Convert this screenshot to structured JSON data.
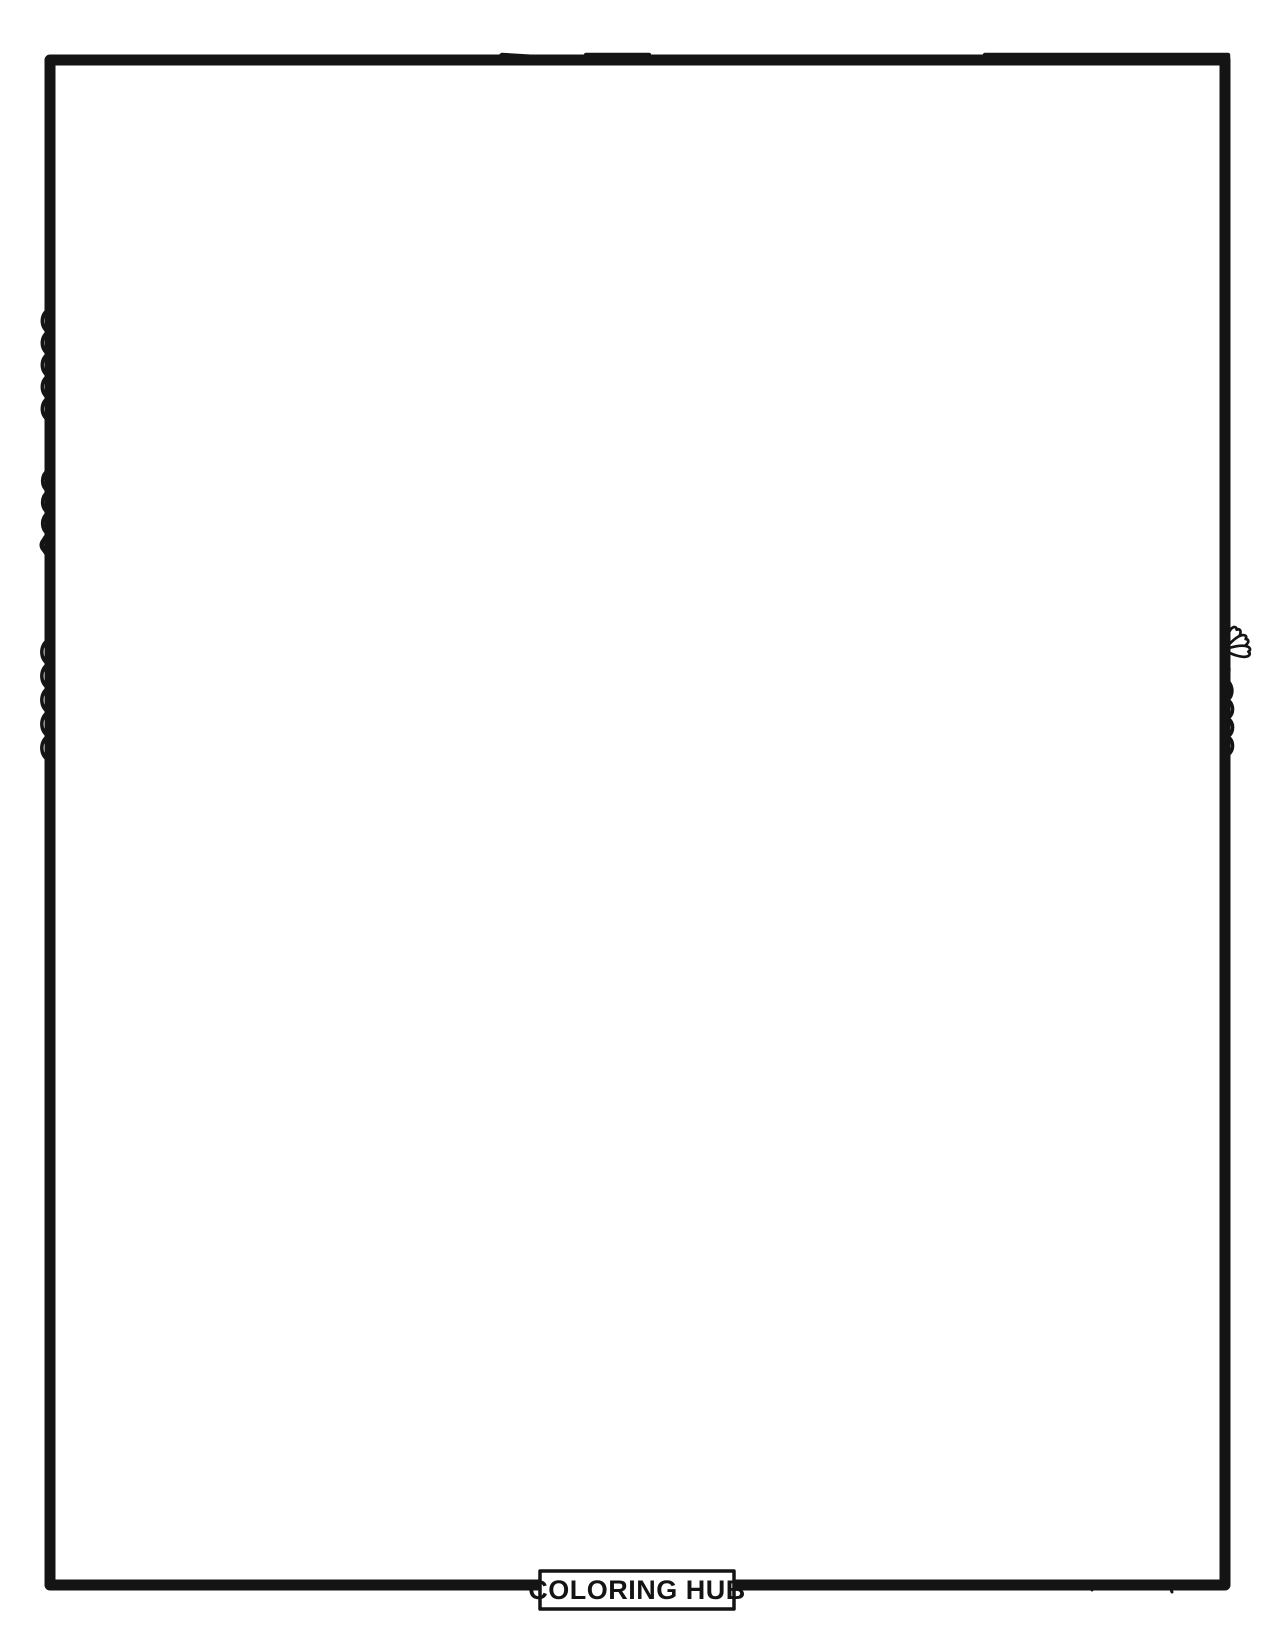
{
  "page": {
    "background": "#ffffff",
    "line_color": "#141414"
  },
  "sign": {
    "text": "WELCOME"
  },
  "badge": {
    "text": "COLORING HUB"
  },
  "scene": {
    "elements": [
      "tree-canopy-left",
      "tree-branches-right",
      "hanging-leaves",
      "welcome-sign",
      "stone-archway",
      "wooden-gate",
      "metal-gate-bands",
      "rivets",
      "arrow-ornaments",
      "climbing-vine-leaves",
      "climbing-vine-flowers",
      "stone-walls",
      "garden-bushes",
      "fern-fronds",
      "boulders",
      "flagstone-path"
    ]
  }
}
